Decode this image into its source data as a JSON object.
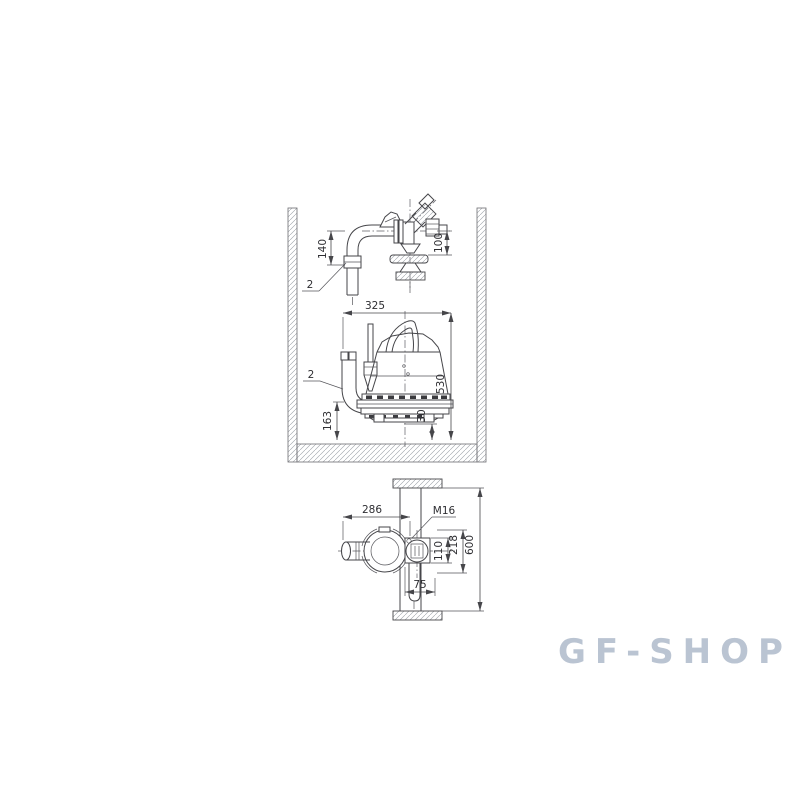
{
  "page": {
    "background": "#ffffff"
  },
  "watermark": {
    "text": "GF-SHOP",
    "color": "#bac4d2"
  },
  "diagram": {
    "description": "Submersible pump free-standing installation dimensional drawing: pipework side view and pump side view inside a pit, plus pump plan view against pit wall",
    "line_color": "#46464a",
    "hatch_color": "#9aa0a6",
    "views": {
      "pipework": {
        "name": "discharge-pipework-side-view",
        "callout": "2",
        "dims": {
          "d140": "140",
          "d100": "100"
        }
      },
      "pump_side": {
        "name": "pump-in-pit-side-view",
        "callout": "2",
        "dims": {
          "d325": "325",
          "d530": "530",
          "d163": "163",
          "d30": "30"
        }
      },
      "pump_plan": {
        "name": "pump-plan-view",
        "callout": "M16",
        "dims": {
          "d286": "286",
          "d110": "110",
          "d218": "218",
          "d600": "600",
          "d75": "75"
        }
      }
    }
  }
}
